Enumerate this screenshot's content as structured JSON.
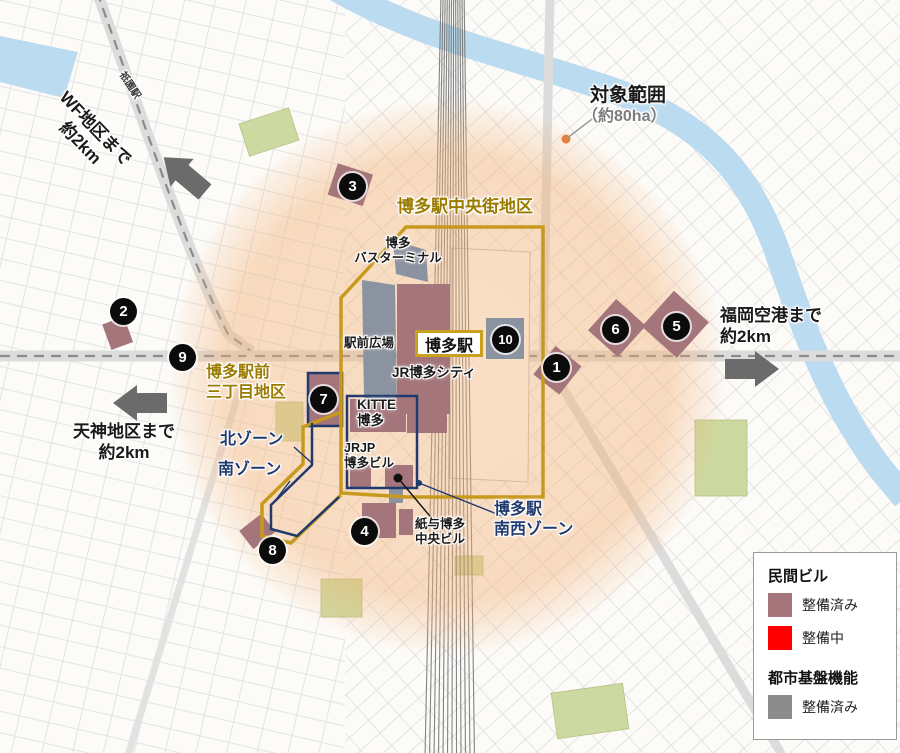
{
  "colors": {
    "boundary_gold": "#c79a1e",
    "boundary_navy": "#1f3a6e",
    "private_built": "#a4767b",
    "private_under_construction": "#ff0000",
    "infra_built": "#8c8c8c",
    "target_circle": "#f3b176",
    "river": "#badbf0",
    "park": "#ccd9a0"
  },
  "annotations": {
    "wf_distance": "WF地区まで\n約2km",
    "tenjin_distance": "天神地区まで\n約2km",
    "airport_distance": "福岡空港まで\n約2km",
    "target_area_title": "対象範囲",
    "target_area_size": "（約80ha）"
  },
  "districts": {
    "chuogai": "博多駅中央街地区",
    "sanchome": "博多駅前\n三丁目地区",
    "north_zone": "北ゾーン",
    "south_zone": "南ゾーン",
    "southwest_zone": "博多駅\n南西ゾーン"
  },
  "places": {
    "hakata_station": "博多駅",
    "gion_station": "祇園駅",
    "bus_terminal": "博多\nバスターミナル",
    "station_plaza": "駅前広場",
    "jr_hakata_city": "JR博多シティ",
    "kitte_hakata": "KITTE\n博多",
    "jrjp_hakata_bldg": "JRJP\n博多ビル",
    "kamiyo_hakata_chuo_bldg": "紙与博多\n中央ビル"
  },
  "markers": [
    {
      "number": "1"
    },
    {
      "number": "2"
    },
    {
      "number": "3"
    },
    {
      "number": "4"
    },
    {
      "number": "5"
    },
    {
      "number": "6"
    },
    {
      "number": "7"
    },
    {
      "number": "8"
    },
    {
      "number": "9"
    },
    {
      "number": "10"
    }
  ],
  "legend": {
    "sections": [
      {
        "title": "民間ビル",
        "items": [
          {
            "label": "整備済み",
            "color": "#a4767b"
          },
          {
            "label": "整備中",
            "color": "#ff0000"
          }
        ]
      },
      {
        "title": "都市基盤機能",
        "items": [
          {
            "label": "整備済み",
            "color": "#8c8c8c"
          }
        ]
      }
    ]
  }
}
